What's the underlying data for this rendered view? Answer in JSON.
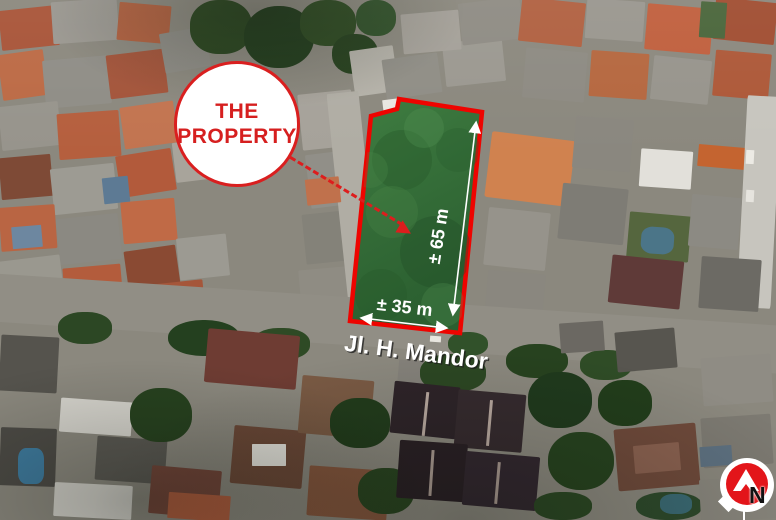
{
  "map_annotations": {
    "property_circle": {
      "line1": "THE",
      "line2": "PROPERTY"
    },
    "dim_vertical": "± 65 m",
    "dim_horizontal": "± 35 m",
    "street_label": "Jl. H. Mandor",
    "compass_letter": "N"
  },
  "icons": {
    "compass": "north-arrow-icon",
    "callout_pointer": "dashed-arrow-icon"
  },
  "colors": {
    "annotation_red": "#dd1d1d",
    "boundary_red": "#ee0400",
    "property_green": "#35703a",
    "dimension_white": "#ffffff",
    "compass_red": "#e3151a"
  }
}
